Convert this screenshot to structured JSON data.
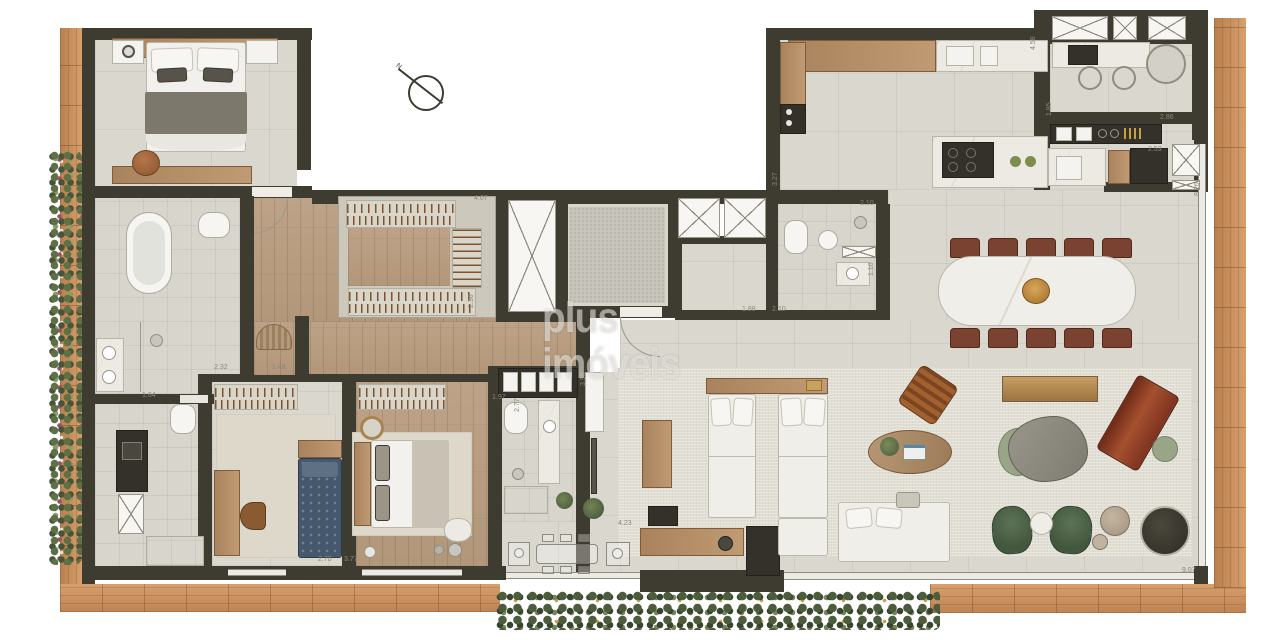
{
  "watermark": {
    "text": "plus imóveis"
  },
  "compass": {
    "label": "N"
  },
  "colors": {
    "wall": "#3e3c30",
    "deck_wood": "#c68a58",
    "floor_tile": "#dad7cf",
    "floor_wood": "#b79b7d",
    "rug": "#e1ded3",
    "marble": "#eceae3",
    "fixture_white": "#f4f3ef",
    "bed_blue": "#46586c",
    "chair_green": "#4c6147",
    "lounger_red": "#8e3f28",
    "dining_chair": "#7a4331",
    "bowl_amber": "#c08a3e",
    "dimension_text": "#8a8779"
  },
  "dimension_labels": [
    {
      "text": "4.07",
      "x": 474,
      "y": 195,
      "rot": 0
    },
    {
      "text": "2.36",
      "x": 468,
      "y": 308,
      "rot": -90
    },
    {
      "text": "2.32",
      "x": 214,
      "y": 364,
      "rot": 0
    },
    {
      "text": "1.48",
      "x": 272,
      "y": 364,
      "rot": 0
    },
    {
      "text": "1.64",
      "x": 142,
      "y": 392,
      "rot": 0
    },
    {
      "text": "2.10",
      "x": 860,
      "y": 200,
      "rot": 0
    },
    {
      "text": "1.10",
      "x": 868,
      "y": 276,
      "rot": -90
    },
    {
      "text": "3.27",
      "x": 772,
      "y": 186,
      "rot": -90
    },
    {
      "text": "1.88",
      "x": 742,
      "y": 306,
      "rot": 0
    },
    {
      "text": "2.10",
      "x": 772,
      "y": 306,
      "rot": 0
    },
    {
      "text": "1.85",
      "x": 1046,
      "y": 116,
      "rot": -90
    },
    {
      "text": "2.86",
      "x": 1160,
      "y": 114,
      "rot": 0
    },
    {
      "text": "2.53",
      "x": 1148,
      "y": 146,
      "rot": 0
    },
    {
      "text": "4.58",
      "x": 1030,
      "y": 50,
      "rot": -90
    },
    {
      "text": "8.26",
      "x": 1194,
      "y": 196,
      "rot": -90
    },
    {
      "text": "9.07",
      "x": 1182,
      "y": 567,
      "rot": 0
    },
    {
      "text": "3.95",
      "x": 580,
      "y": 386,
      "rot": -90
    },
    {
      "text": "4.23",
      "x": 618,
      "y": 520,
      "rot": 0
    },
    {
      "text": "2.70",
      "x": 318,
      "y": 556,
      "rot": 0
    },
    {
      "text": "3.77",
      "x": 344,
      "y": 556,
      "rot": 0
    },
    {
      "text": "2.77",
      "x": 514,
      "y": 412,
      "rot": -90
    },
    {
      "text": "1.97",
      "x": 492,
      "y": 394,
      "rot": 0
    }
  ]
}
